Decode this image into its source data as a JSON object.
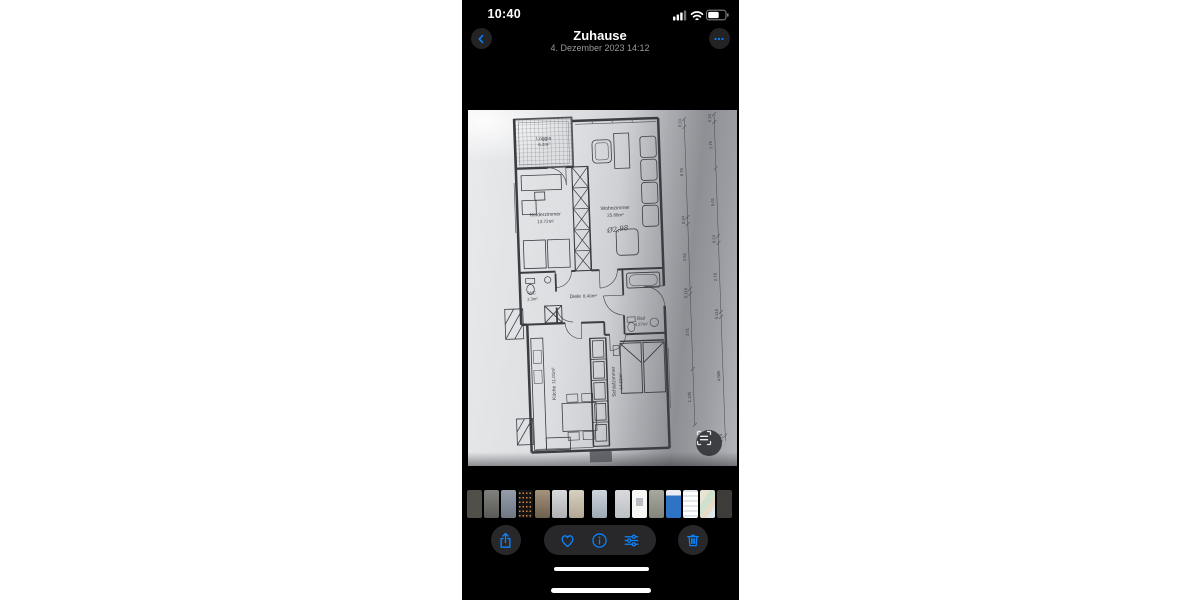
{
  "colors": {
    "accent": "#0a84ff",
    "chrome": "#28282a",
    "paper_light": "#dcdde0",
    "paper_dark": "#8d8f94"
  },
  "status_bar": {
    "time": "10:40",
    "icons": [
      "cellular-signal",
      "wifi",
      "battery"
    ]
  },
  "nav": {
    "title": "Zuhause",
    "subtitle": "4. Dezember 2023 14:12"
  },
  "photo": {
    "kind": "scanned floor plan",
    "floor_plan": {
      "rooms": {
        "loggia": {
          "name": "Loggia",
          "area": "6.2m²"
        },
        "kinderzimmer": {
          "name": "Kinderzimmer",
          "area": "13.72m²"
        },
        "wohnzimmer": {
          "name": "Wohnzimmer",
          "area": "25.88m²"
        },
        "diele": {
          "name": "Diele",
          "area": "8.40m²"
        },
        "wc": {
          "name": "WC",
          "area": "1.3m²"
        },
        "bad": {
          "name": "Bad",
          "area": "4.27m²"
        },
        "kueche": {
          "name": "Küche",
          "area": "11.01m²"
        },
        "schlafzimmer": {
          "name": "Schlafzimmer",
          "area": "14.53m²"
        }
      },
      "handwritten_note": "Ø2,98",
      "dimensions_inner": [
        "0.24",
        "6.76",
        "0.24",
        "2.51",
        "0.115",
        "3.01",
        "1.105"
      ],
      "dimensions_outer": [
        "0.24",
        "1.75",
        "5.01",
        "0.24",
        "2.76",
        "0.115",
        "4.885",
        "0.24"
      ]
    }
  },
  "thumbnails": [
    {
      "bg": "#514f4a"
    },
    {
      "bg": "linear-gradient(180deg,#80807c,#5a5a56)"
    },
    {
      "bg": "linear-gradient(180deg,#959dab,#6f7783)"
    },
    {
      "bg": "radial-gradient(circle, #d9883c 0.7px, rgba(0,0,0,0) 1px) 0 10px / 3.5px 4.5px repeat #141414"
    },
    {
      "bg": "linear-gradient(180deg,#a4927c,#6d5f4e)"
    },
    {
      "bg": "linear-gradient(180deg,#d9dadc,#aeb0b4)"
    },
    {
      "bg": "linear-gradient(180deg,#d6cfc0,#b3a894)",
      "gap_after": true
    },
    {
      "bg": "linear-gradient(180deg,#cdd5dc,#9fa9b3)",
      "gap_after": true
    },
    {
      "bg": "linear-gradient(180deg,#d8dadc,#bdc0c4)"
    },
    {
      "bg": "linear-gradient(180deg,#b9bcc0 0 0) 50% 40% / 7px 8px no-repeat #f6f6f4"
    },
    {
      "bg": "linear-gradient(180deg,#a8a89e,#83857b)"
    },
    {
      "bg": "linear-gradient(180deg,#e9edf1 0 20%,#2e74c4 20% 100%)"
    },
    {
      "bg": "repeating-linear-gradient(180deg,#e4e6ea 0 2px,#ffffff 2px 5px) #ffffff"
    },
    {
      "bg": "linear-gradient(125deg,#e9e3d4 0 30%,#cfe0cc 30% 55%,#e6d9c6 55% 75%,#dde8ee 75%)"
    },
    {
      "bg": "#3e3c38"
    }
  ],
  "toolbar": {
    "buttons": [
      "share",
      "favorite",
      "info",
      "adjust",
      "delete"
    ]
  }
}
